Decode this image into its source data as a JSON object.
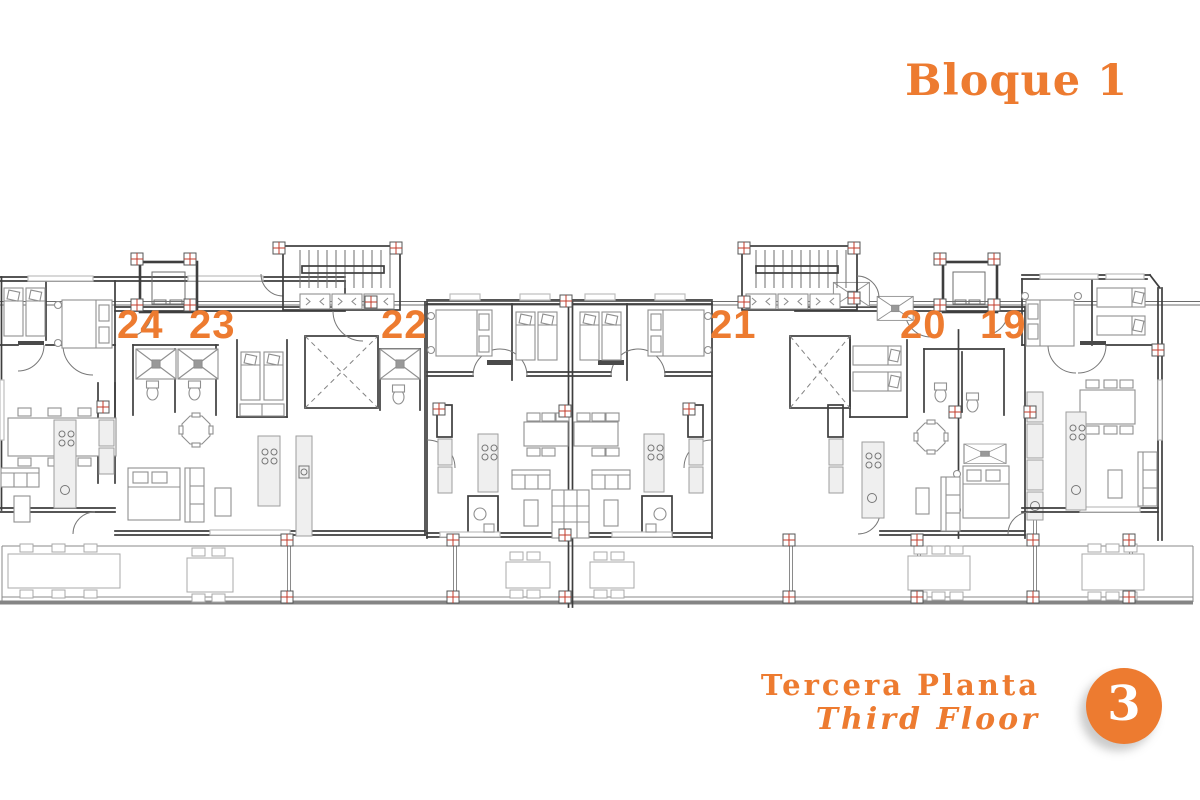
{
  "block_title": "Bloque 1",
  "units": [
    {
      "number": "24"
    },
    {
      "number": "23"
    },
    {
      "number": "22"
    },
    {
      "number": "21"
    },
    {
      "number": "20"
    },
    {
      "number": "19"
    }
  ],
  "footer": {
    "floor_label_es": "Tercera Planta",
    "floor_label_en": "Third Floor",
    "floor_badge": "3"
  },
  "colors": {
    "accent_orange": "#ED7B30",
    "wall_gray": "#3e3e3e",
    "furniture_gray": "#8f8f8f",
    "marker_red": "#C23B2B",
    "terrace_gray": "#8a8a8a"
  }
}
